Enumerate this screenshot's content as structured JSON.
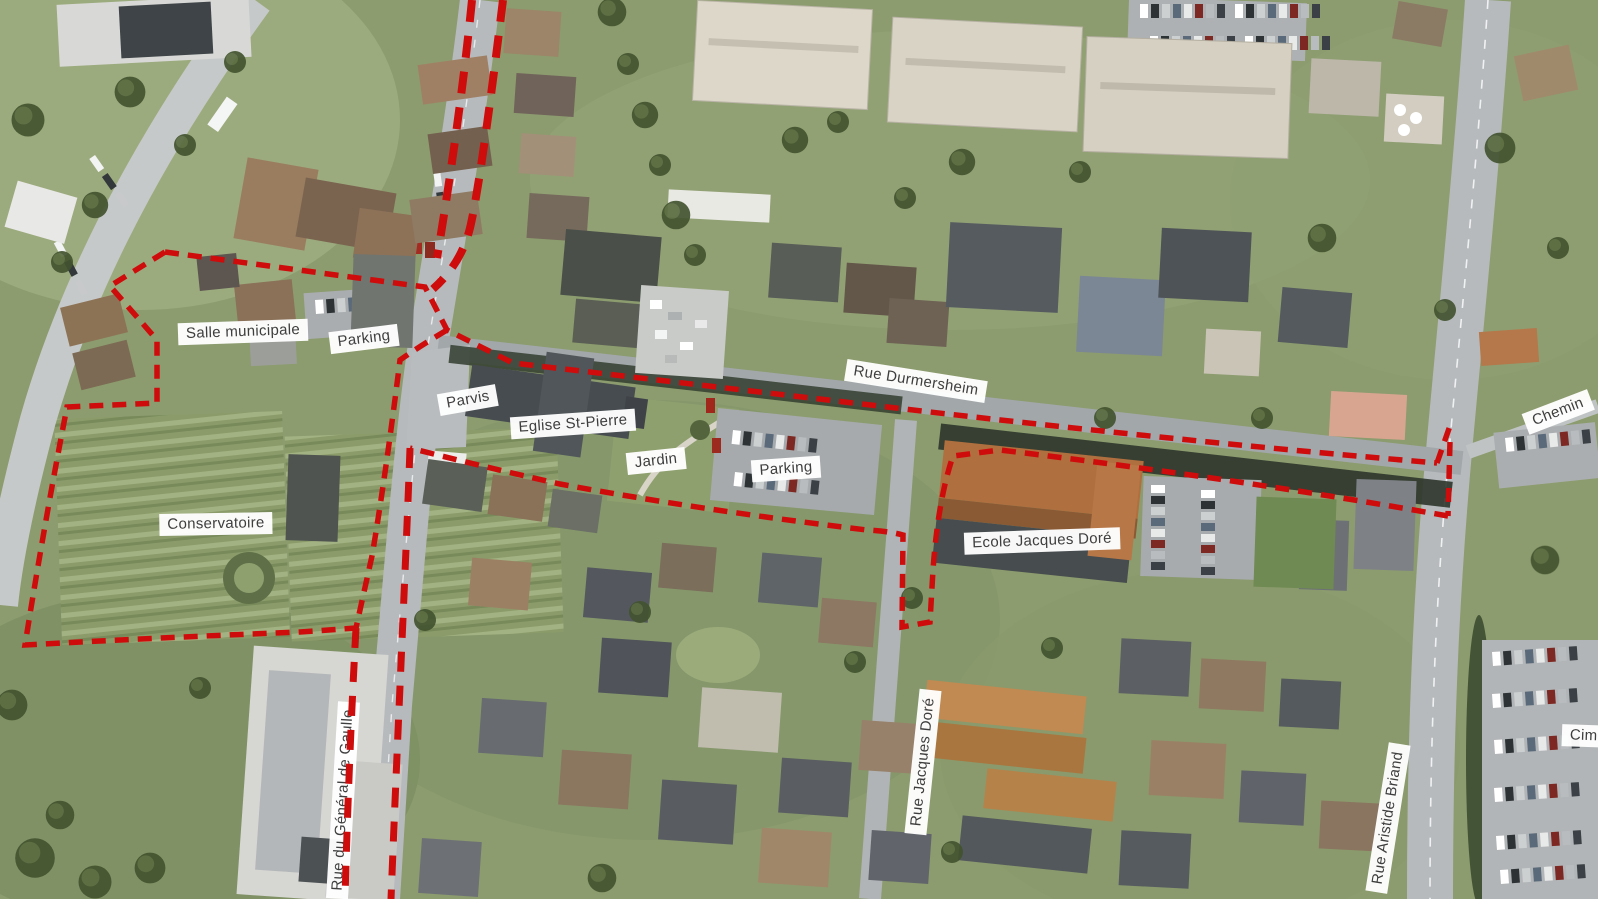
{
  "map": {
    "description": "Annotated aerial photograph of a town centre with a red dashed project perimeter",
    "boundary_color": "#ce0c0c",
    "labels": {
      "salle_municipale": "Salle municipale",
      "parking_top": "Parking",
      "parvis": "Parvis",
      "eglise_st_pierre": "Eglise St-Pierre",
      "jardin": "Jardin",
      "parking_center": "Parking",
      "conservatoire": "Conservatoire",
      "ecole_jacques_dore": "Ecole Jacques Doré",
      "rue_durmersheim": "Rue Durmersheim",
      "rue_jacques_dore": "Rue Jacques Doré",
      "rue_aristide_briand": "Rue Aristide Briand",
      "rue_du_general_de_gaulle": "Rue du Général de Gaulle",
      "chemin": "Chemin",
      "cimetiere": "Cime"
    }
  }
}
